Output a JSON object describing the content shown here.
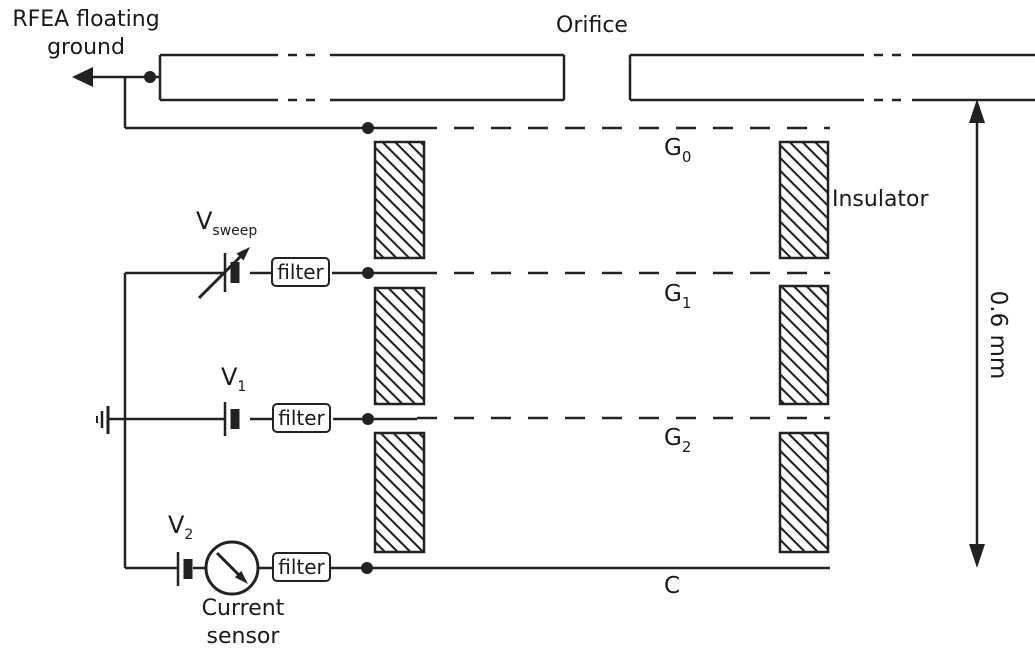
{
  "title": "RFEA schematic diagram",
  "labels": {
    "floating_ground_line1": "RFEA floating",
    "floating_ground_line2": "ground",
    "orifice": "Orifice",
    "insulator": "Insulator",
    "dimension": "0.6 mm",
    "filter": "filter",
    "current_sensor_line1": "Current",
    "current_sensor_line2": "sensor",
    "collector": "C"
  },
  "grids": [
    {
      "symbol": "G",
      "subscript": "0"
    },
    {
      "symbol": "G",
      "subscript": "1"
    },
    {
      "symbol": "G",
      "subscript": "2"
    }
  ],
  "sources": [
    {
      "symbol": "V",
      "subscript": "sweep"
    },
    {
      "symbol": "V",
      "subscript": "1"
    },
    {
      "symbol": "V",
      "subscript": "2"
    }
  ],
  "symbols": {
    "ground": "ground-icon",
    "battery": "battery-icon",
    "variable_source": "variable-source-arrow-icon",
    "current_sensor": "current-sensor-icon",
    "junction": "junction-dot",
    "dimension": "double-headed-arrow-icon",
    "floating_ground_arrow": "left-arrow-icon"
  },
  "colors": {
    "line": "#222222",
    "text": "#1a1a1a",
    "background": "#ffffff"
  }
}
